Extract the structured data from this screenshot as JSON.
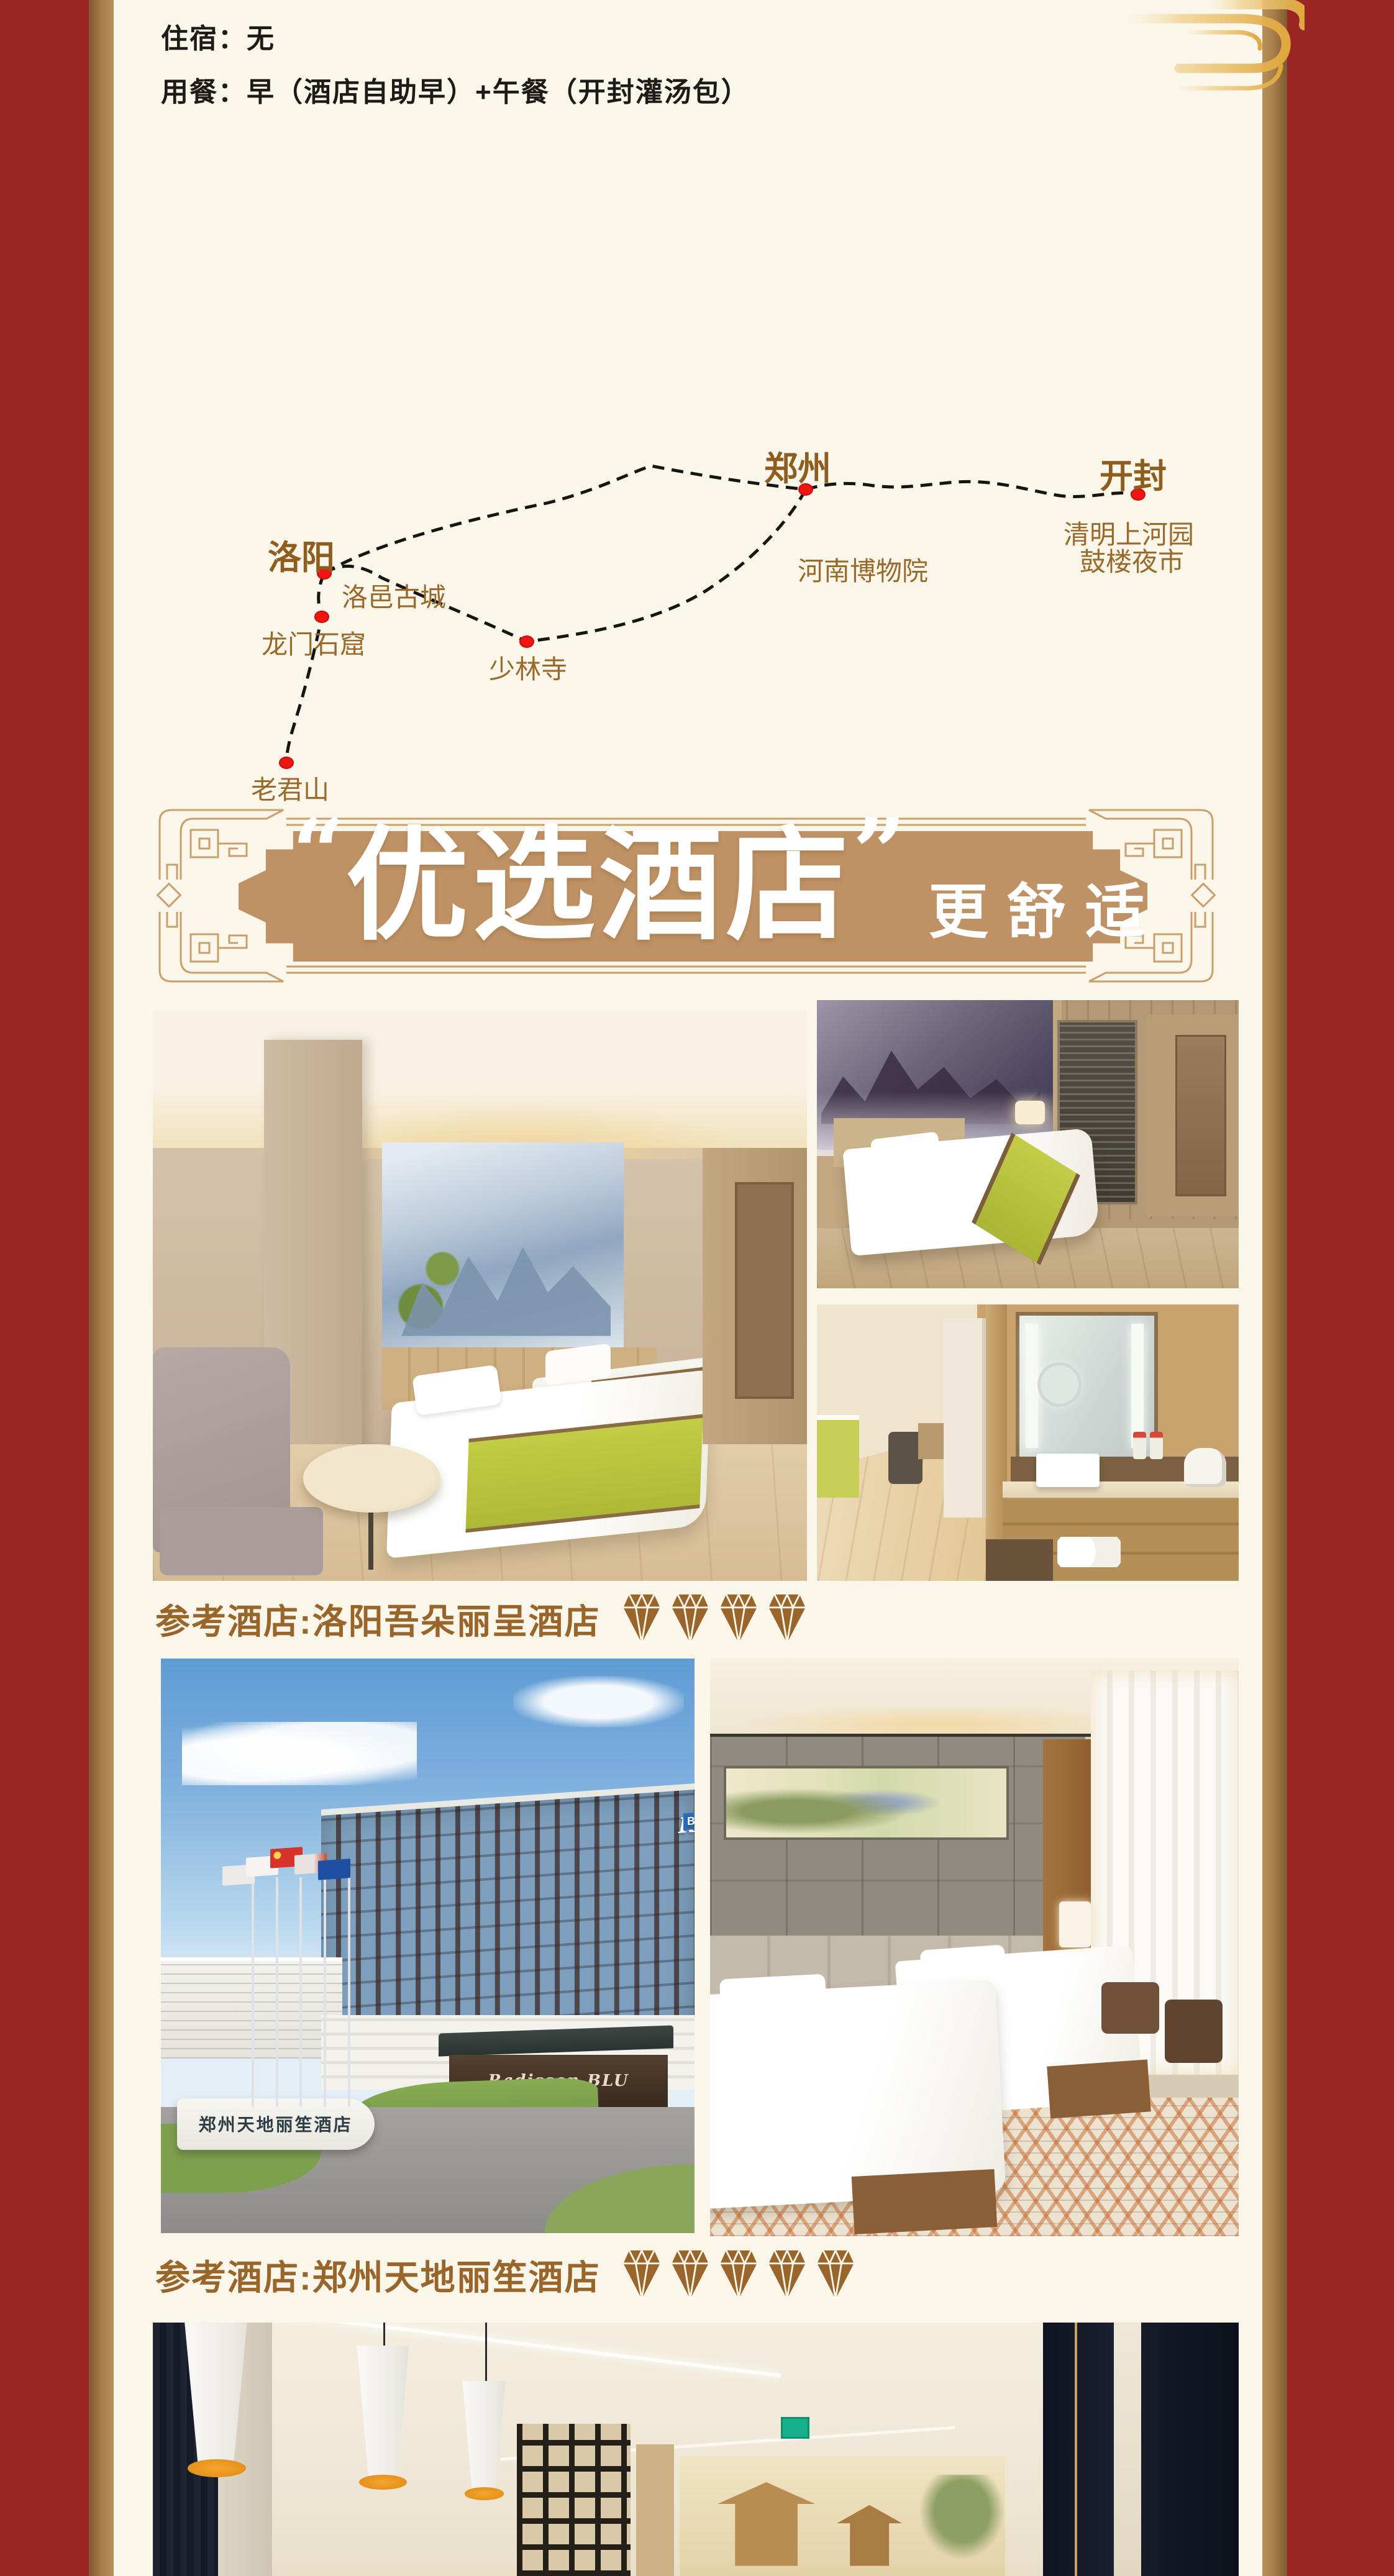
{
  "colors": {
    "page_red": "#9B2523",
    "card_cream": "#FBF6EA",
    "edge_tan": "#A87F4C",
    "text_brown": "#99652A",
    "city_brown": "#8F5E1F",
    "plaque_tan": "#BE9264",
    "frame_gold": "#C9A06B",
    "dot_red": "#EE1512",
    "banner_text": "#FFFFFF"
  },
  "header": {
    "line1": "住宿：无",
    "line2": "用餐：早（酒店自助早）+午餐（开封灌汤包）"
  },
  "map": {
    "points": [
      {
        "label": "洛阳",
        "type": "city"
      },
      {
        "label": "郑州",
        "type": "city"
      },
      {
        "label": "开封",
        "type": "city"
      },
      {
        "label": "洛邑古城",
        "type": "attraction"
      },
      {
        "label": "龙门石窟",
        "type": "attraction"
      },
      {
        "label": "少林寺",
        "type": "attraction"
      },
      {
        "label": "老君山",
        "type": "attraction"
      },
      {
        "label": "河南博物院",
        "type": "attraction"
      },
      {
        "label": "清明上河园",
        "type": "attraction"
      },
      {
        "label": "鼓楼夜市",
        "type": "attraction"
      }
    ]
  },
  "banner": {
    "open_quote": "“",
    "title": "优选酒店",
    "close_quote": "”",
    "subtitle": "更舒适"
  },
  "hotels": [
    {
      "caption": "参考酒店:洛阳吾朵丽呈酒店",
      "diamonds": 4
    },
    {
      "caption": "参考酒店:郑州天地丽笙酒店",
      "diamonds": 5
    }
  ],
  "photo_signs": {
    "radisson_brand": "Radisson",
    "radisson_suffix": "BLU",
    "entrance_sign": "Radisson BLU",
    "monument": "郑州天地丽笙酒店"
  }
}
